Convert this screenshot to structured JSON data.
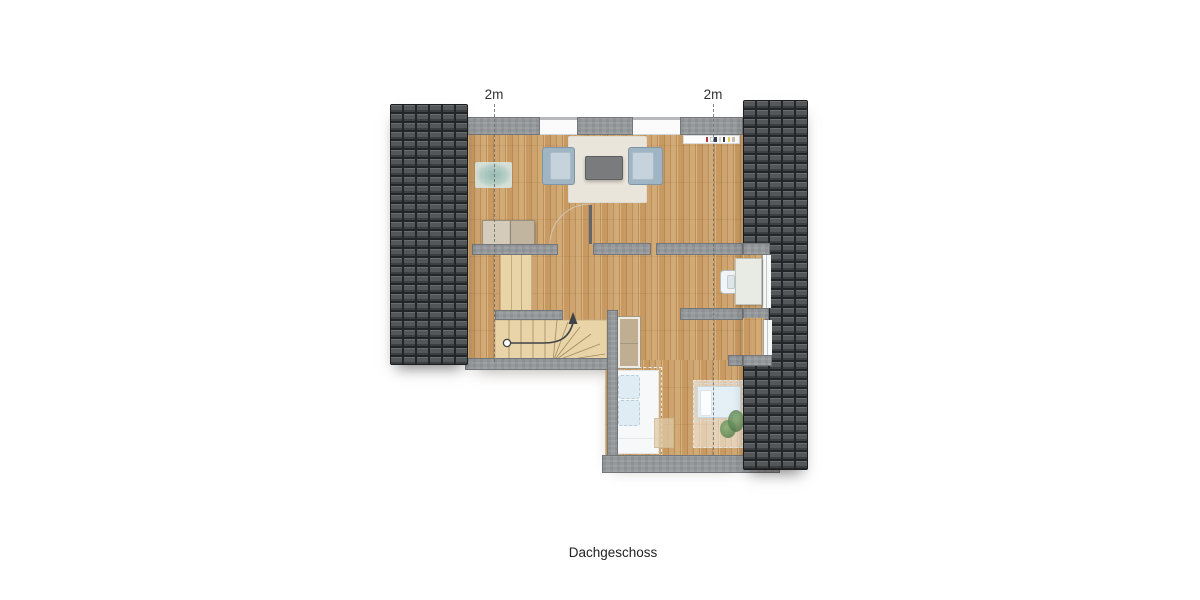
{
  "caption": {
    "text": "Dachgeschoss"
  },
  "height_markers": {
    "left": "2m",
    "right": "2m"
  },
  "colors": {
    "page_bg": "#ffffff",
    "roof_tile_face": "#54575a",
    "roof_tile_gap": "#232527",
    "wall_concrete": "#96999c",
    "wall_edge": "#74777a",
    "wood_floor": "#c89a61",
    "stair_wood": "#e9d4a8",
    "rug_cream": "#eae5da",
    "rug_teal": "#b5d4d1",
    "armchair_blue": "#9fb5c4",
    "table_gray": "#797b7d",
    "dresser_tan": "#bfae92",
    "bed_white": "#f7f8f9",
    "bed_blue": "#dfecf4",
    "plant_green": "#6f9a60",
    "dashed_line": "#707070",
    "marker_text": "#333333",
    "caption_text": "#222222",
    "book_colors": [
      "#b03a3a",
      "#ffffff",
      "#2e3d55",
      "#d9d2c4",
      "#3a3a3a",
      "#e8c85a",
      "#c8c2b4"
    ]
  },
  "icons": {
    "stair_direction": "stair-direction-arrow",
    "door_swing": "door-swing-arc"
  }
}
